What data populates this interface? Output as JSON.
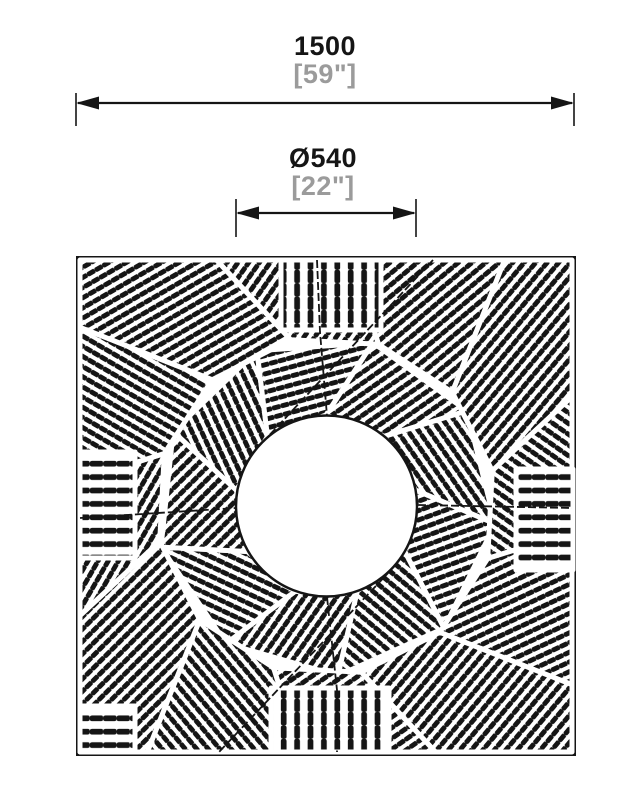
{
  "dimensions": {
    "overall_width": {
      "metric": "1500",
      "imperial": "[59\"]"
    },
    "opening_diameter": {
      "metric": "Ø540",
      "imperial": "[22\"]"
    }
  },
  "colors": {
    "line": "#151515",
    "muted_text": "#9b9b9b",
    "background": "#ffffff"
  }
}
